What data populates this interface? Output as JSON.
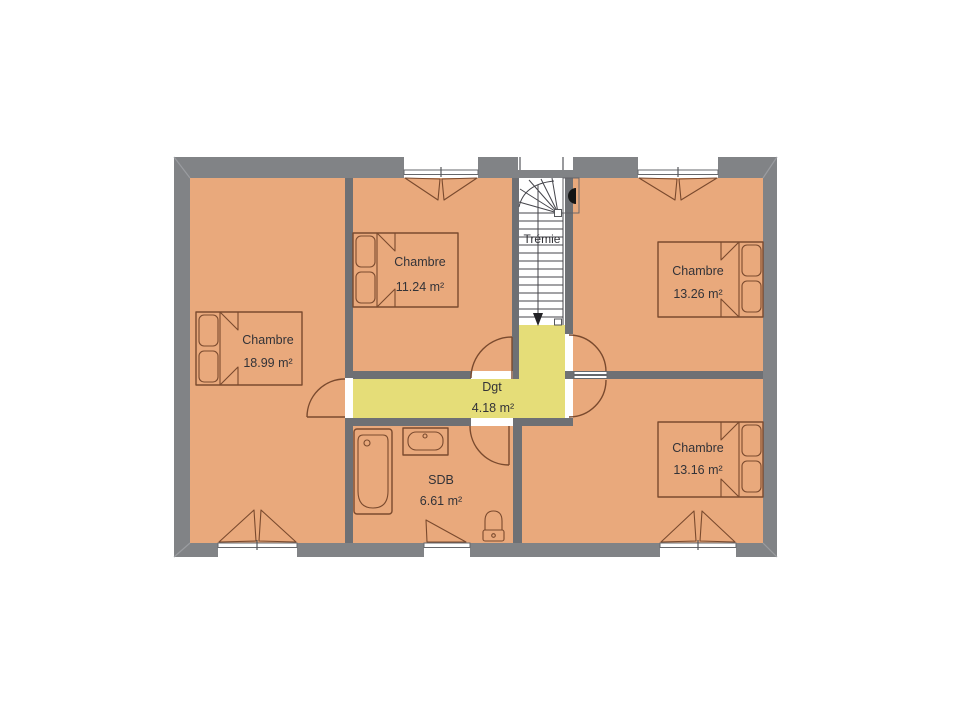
{
  "background": "#ffffff",
  "colors": {
    "wall_exterior": "#818386",
    "wall_interior": "#6e7074",
    "floor": "#e9a97c",
    "hallway": "#e5dd78",
    "furniture_outline": "#7a4a2e",
    "stair_lines": "#45454b",
    "label_text": "#333338",
    "window_glass": "#ffffff"
  },
  "rooms": [
    {
      "name": "Chambre",
      "area": "18.99 m²"
    },
    {
      "name": "Chambre",
      "area": "11.24 m²"
    },
    {
      "name": "Chambre",
      "area": "13.26 m²"
    },
    {
      "name": "Chambre",
      "area": "13.16 m²"
    },
    {
      "name": "Dgt",
      "area": "4.18 m²"
    },
    {
      "name": "SDB",
      "area": "6.61 m²"
    }
  ],
  "stairwell": {
    "label": "Trémie"
  }
}
